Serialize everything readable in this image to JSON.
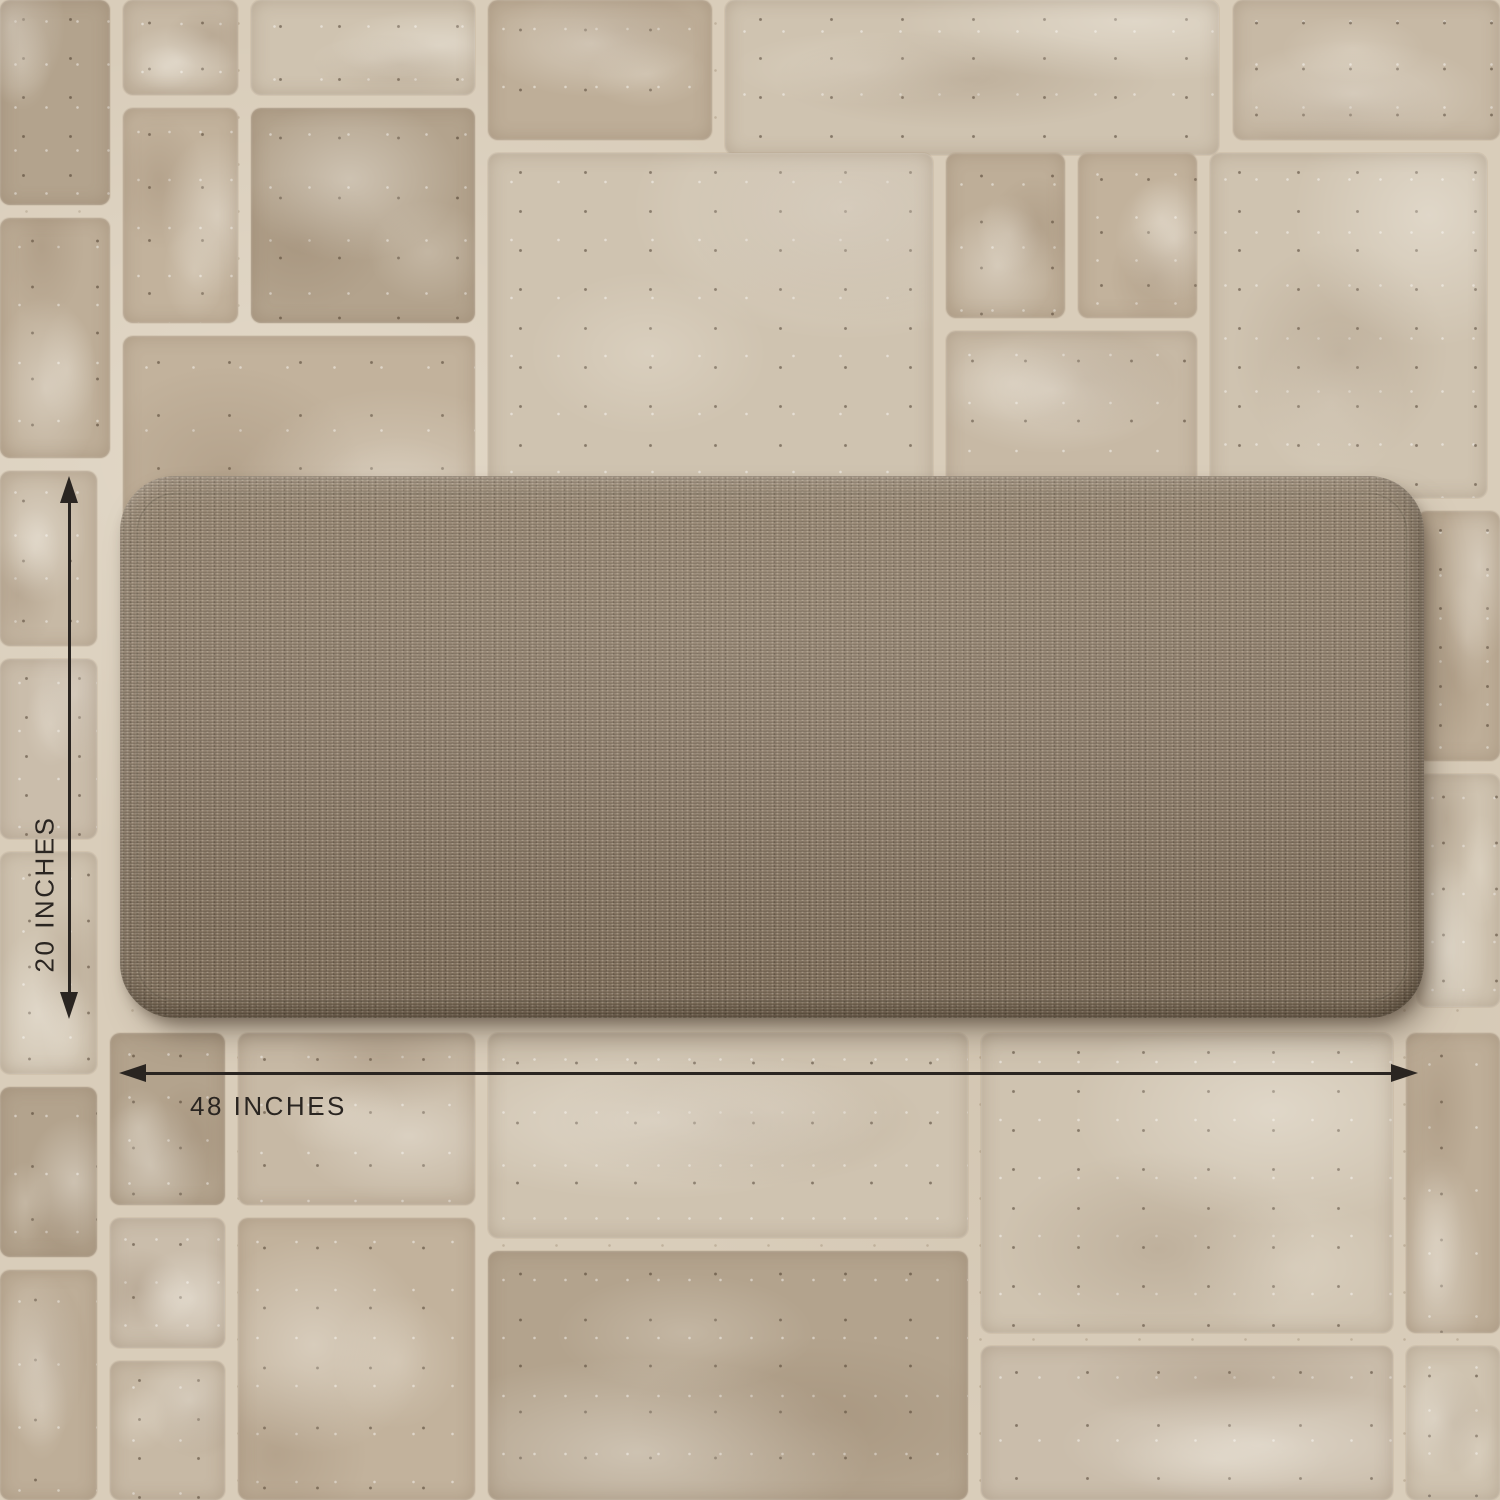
{
  "dimension_annotations": {
    "height": {
      "label": "20 INCHES"
    },
    "width": {
      "label": "48 INCHES"
    }
  },
  "colors": {
    "annotation_ink": "#2a2521",
    "grout": "#d9cdba",
    "mat_base": "#8b7b69",
    "tile_palette": [
      "#cfc3b0",
      "#c7b9a5",
      "#beae98",
      "#b3a38d",
      "#cabdab",
      "#c2b29c"
    ]
  }
}
